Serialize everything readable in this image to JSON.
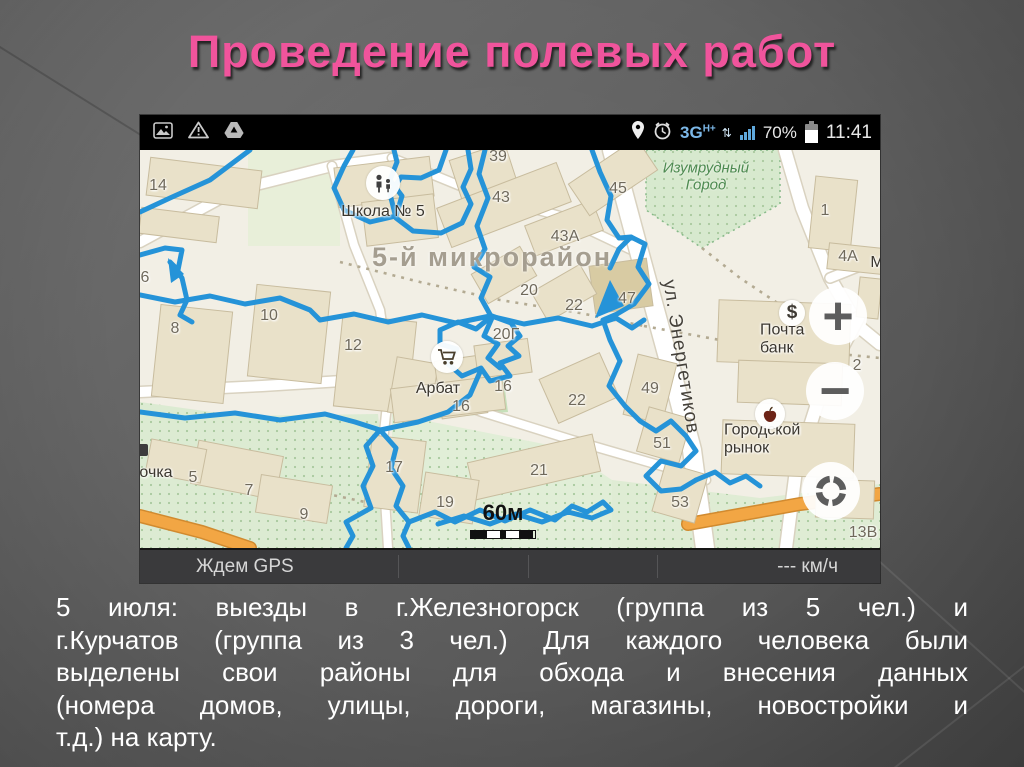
{
  "slide": {
    "title": "Проведение полевых работ",
    "title_color": "#f0549c",
    "body_lines": [
      "5 июля: выезды в г.Железногорск (группа из 5 чел.) и",
      "г.Курчатов (группа из 3 чел.) Для каждого человека были",
      "выделены свои районы для обхода и внесения данных",
      "(номера домов, улицы, дороги, магазины, новостройки и",
      "т.д.) на карту."
    ]
  },
  "phone": {
    "status_bar": {
      "left_icons": [
        "gallery-icon",
        "warning-icon",
        "drive-icon"
      ],
      "right_icons": [
        "location-pin-icon",
        "alarm-clock-icon",
        "signal-bars-icon",
        "battery-icon"
      ],
      "network": "3G",
      "network_super": "H+",
      "battery_percent": "70%",
      "time": "11:41"
    },
    "bottom_bar": {
      "gps_status": "Ждем GPS",
      "speed": "--- км/ч"
    },
    "map": {
      "scale_label": "60м",
      "controls": {
        "zoom_in": "+",
        "zoom_out": "−"
      },
      "poi_dollar_glyph": "$",
      "palette": {
        "map_bg": "#f2efe5",
        "building": "#e9e1c9",
        "building_dark": "#d8cba3",
        "building_edge": "#c8bc9e",
        "green_border": "#86b988",
        "tree_dot": "#a9c99e",
        "path_dot": "#b3aa92",
        "road_white": "#ffffff",
        "road_casing": "#d9d2c0",
        "road_orange": "#f2a644"
      },
      "track": {
        "color": "#2593d8",
        "width": 5,
        "lines": [
          "213,0 204,16 194,38 204,60 230,72 256,66 262,46 250,30 257,12 254,0",
          "306,0 299,20 281,28 261,27 250,44 256,68 273,81 301,83 322,73 331,54 323,37 331,19 328,0",
          "345,0 339,24 348,48 337,76 345,99 334,117 350,127 341,148 352,168 344,186 358,194 348,208 360,218",
          "180,170 214,164 248,172 282,165 316,173 350,166 384,174 418,168 452,176 476,168 492,178 504,170",
          "300,180 318,172 336,179 352,166 371,173 380,186 368,196 379,206 360,213 370,226 350,231 341,218 322,226 307,213 317,199 300,194 300,180",
          "470,118 479,99 491,87 505,94 498,117 509,134 494,154 477,164 463,170 470,190 480,211 469,236 485,256 500,271 516,281 531,271 546,286 556,301 541,316 521,311 506,326 521,341 541,339 556,330",
          "452,0 460,22 471,46 467,70 479,88 491,87",
          "110,0 70,30 30,48 0,62",
          "0,105 25,98 42,100 38,120 30,112 42,128 47,150 40,165 52,172",
          "240,280 226,296 233,316 223,336 231,358 206,372 213,386 206,398",
          "240,280 256,298 251,318 263,336 256,356 269,372 263,386 269,398",
          "269,372 295,362 315,372 340,360 365,371 390,360 415,370 432,356 447,362 463,352 471,360 452,368 428,362 402,372 376,364 350,374 324,366 298,374",
          "556,330 575,322 590,333 606,326 620,336",
          "0,145 35,152 70,146 105,154 140,148 170,160 180,170",
          "0,262 45,268 95,263 140,270 185,264 215,272 240,280",
          "340,222 330,245 308,262 278,272 240,280"
        ],
        "arrows": [
          "455,168 470,130 484,156",
          "28,108 44,124 31,133"
        ]
      },
      "greens": [
        {
          "pts": "108,0 200,0 200,96 108,96",
          "fill": "#e8efd9",
          "dots": false,
          "border": false
        },
        {
          "pts": "506,0 640,0 640,54 562,98 506,60",
          "fill": "#d7e9ce",
          "dots": true,
          "border": true
        },
        {
          "pts": "0,252 100,266 238,264 252,398 0,398",
          "fill": "#dcebd2",
          "dots": true,
          "border": false
        },
        {
          "pts": "252,264 424,298 472,330 472,398 252,398",
          "fill": "#e1eed7",
          "dots": true,
          "border": false
        },
        {
          "pts": "472,330 620,348 740,334 740,398 472,398",
          "fill": "#dfecd4",
          "dots": true,
          "border": false
        },
        {
          "pts": "258,240 364,232 368,262 262,272",
          "fill": "#c6e0ba",
          "dots": false,
          "border": false
        }
      ],
      "roads": [
        {
          "pts": "0,92 96,40 192,16 252,8",
          "w": 10,
          "color": "#ffffff",
          "casing": "#d9d2c0"
        },
        {
          "pts": "252,8 340,44 420,66 500,104",
          "w": 8,
          "color": "#ffffff",
          "casing": "#d9d2c0"
        },
        {
          "pts": "192,16 214,95 240,160 250,228",
          "w": 8,
          "color": "#ffffff",
          "casing": "#d9d2c0"
        },
        {
          "pts": "0,242 122,236 250,228",
          "w": 10,
          "color": "#ffffff",
          "casing": "#d9d2c0"
        },
        {
          "pts": "250,228 242,300 248,398",
          "w": 8,
          "color": "#ffffff",
          "casing": "#d9d2c0"
        },
        {
          "pts": "250,228 342,262 432,290 522,316 566,330",
          "w": 8,
          "color": "#ffffff",
          "casing": "#d9d2c0"
        },
        {
          "pts": "472,0 500,105 530,215 552,300 565,398",
          "w": 18,
          "color": "#ffffff",
          "casing": "#d9d2c0"
        },
        {
          "pts": "645,0 662,58 690,128 718,176 740,194",
          "w": 12,
          "color": "#ffffff",
          "casing": "#d9d2c0"
        },
        {
          "pts": "718,168 684,232 656,320 646,398",
          "w": 12,
          "color": "#ffffff",
          "casing": "#d9d2c0"
        },
        {
          "pts": "690,128 740,108",
          "w": 9,
          "color": "#ffffff",
          "casing": "#d9d2c0"
        },
        {
          "pts": "548,374 660,354 740,344",
          "w": 11,
          "color": "#f2a644",
          "casing": "#d18a2f"
        },
        {
          "pts": "0,366 62,382 110,398",
          "w": 11,
          "color": "#f2a644",
          "casing": "#d18a2f"
        }
      ],
      "paths_dotted": [
        "200,112 280,132 360,150 440,163 504,176",
        "504,176 580,190 660,200 740,208",
        "20,300 90,318 160,338 225,352",
        "562,98 600,128 645,158"
      ],
      "buildings": [
        [
          8,
          14,
          112,
          38,
          7
        ],
        [
          0,
          62,
          78,
          26,
          7
        ],
        [
          196,
          12,
          96,
          40,
          -7
        ],
        [
          224,
          48,
          72,
          44,
          -7
        ],
        [
          318,
          0,
          58,
          66,
          -18
        ],
        [
          300,
          34,
          128,
          42,
          -21
        ],
        [
          388,
          62,
          72,
          32,
          -21
        ],
        [
          432,
          8,
          82,
          38,
          -34
        ],
        [
          452,
          112,
          58,
          48,
          -8,
          1
        ],
        [
          672,
          28,
          42,
          72,
          6
        ],
        [
          688,
          96,
          62,
          26,
          6
        ],
        [
          718,
          128,
          22,
          40,
          6
        ],
        [
          578,
          152,
          132,
          62,
          2
        ],
        [
          598,
          212,
          104,
          42,
          2
        ],
        [
          582,
          272,
          132,
          54,
          2
        ],
        [
          16,
          158,
          72,
          92,
          6
        ],
        [
          112,
          138,
          74,
          92,
          6
        ],
        [
          198,
          168,
          74,
          92,
          6
        ],
        [
          336,
          108,
          56,
          34,
          -30
        ],
        [
          396,
          126,
          56,
          34,
          -30
        ],
        [
          252,
          210,
          42,
          56,
          10
        ],
        [
          298,
          208,
          46,
          58,
          -8
        ],
        [
          336,
          192,
          54,
          34,
          -8
        ],
        [
          406,
          214,
          66,
          48,
          -24
        ],
        [
          490,
          208,
          40,
          62,
          14
        ],
        [
          502,
          262,
          44,
          46,
          16
        ],
        [
          518,
          318,
          44,
          50,
          16
        ],
        [
          330,
          298,
          128,
          38,
          -13
        ],
        [
          228,
          288,
          54,
          72,
          7
        ],
        [
          282,
          326,
          54,
          44,
          9
        ],
        [
          54,
          298,
          86,
          44,
          11
        ],
        [
          118,
          330,
          72,
          38,
          9
        ],
        [
          8,
          294,
          56,
          34,
          11
        ],
        [
          252,
          232,
          112,
          34,
          -7
        ],
        [
          676,
          330,
          58,
          38,
          2
        ]
      ],
      "labels": [
        {
          "t": "14",
          "x": 18,
          "y": 36,
          "cls": "num"
        },
        {
          "t": "6",
          "x": 5,
          "y": 128,
          "cls": "num"
        },
        {
          "t": "39",
          "x": 358,
          "y": 7,
          "cls": "num"
        },
        {
          "t": "43",
          "x": 361,
          "y": 48,
          "cls": "num"
        },
        {
          "t": "43А",
          "x": 425,
          "y": 87,
          "cls": "num"
        },
        {
          "t": "45",
          "x": 478,
          "y": 39,
          "cls": "num"
        },
        {
          "t": "1",
          "x": 685,
          "y": 61,
          "cls": "num"
        },
        {
          "t": "4А",
          "x": 708,
          "y": 107,
          "cls": "num"
        },
        {
          "t": "М",
          "x": 737,
          "y": 113,
          "cls": "poi"
        },
        {
          "t": "20",
          "x": 389,
          "y": 141,
          "cls": "num"
        },
        {
          "t": "22",
          "x": 434,
          "y": 156,
          "cls": "num"
        },
        {
          "t": "47",
          "x": 487,
          "y": 149,
          "cls": "num"
        },
        {
          "t": "2",
          "x": 717,
          "y": 216,
          "cls": "num"
        },
        {
          "t": "10",
          "x": 129,
          "y": 166,
          "cls": "num"
        },
        {
          "t": "8",
          "x": 35,
          "y": 179,
          "cls": "num"
        },
        {
          "t": "12",
          "x": 213,
          "y": 196,
          "cls": "num"
        },
        {
          "t": "20Г",
          "x": 366,
          "y": 185,
          "cls": "num"
        },
        {
          "t": "16",
          "x": 363,
          "y": 237,
          "cls": "num"
        },
        {
          "t": "16",
          "x": 321,
          "y": 257,
          "cls": "num"
        },
        {
          "t": "22",
          "x": 437,
          "y": 251,
          "cls": "num"
        },
        {
          "t": "49",
          "x": 510,
          "y": 239,
          "cls": "num"
        },
        {
          "t": "51",
          "x": 522,
          "y": 294,
          "cls": "num"
        },
        {
          "t": "53",
          "x": 540,
          "y": 353,
          "cls": "num"
        },
        {
          "t": "21",
          "x": 399,
          "y": 321,
          "cls": "num"
        },
        {
          "t": "17",
          "x": 254,
          "y": 318,
          "cls": "num"
        },
        {
          "t": "19",
          "x": 305,
          "y": 353,
          "cls": "num"
        },
        {
          "t": "7",
          "x": 109,
          "y": 341,
          "cls": "num"
        },
        {
          "t": "9",
          "x": 164,
          "y": 365,
          "cls": "num"
        },
        {
          "t": "5",
          "x": 53,
          "y": 328,
          "cls": "num"
        },
        {
          "t": "13В",
          "x": 723,
          "y": 383,
          "cls": "num"
        },
        {
          "t": "Школа № 5",
          "x": 243,
          "y": 62,
          "cls": "poi"
        },
        {
          "t": "Почта банк",
          "x": 660,
          "y": 189,
          "cls": "poi"
        },
        {
          "t": "Городской рынок",
          "x": 636,
          "y": 289,
          "cls": "poi"
        },
        {
          "t": "Арбат",
          "x": 298,
          "y": 239,
          "cls": "poi"
        },
        {
          "t": "очка",
          "x": 16,
          "y": 323,
          "cls": "poi"
        },
        {
          "t": "Изумрудный\nГород",
          "x": 566,
          "y": 27,
          "cls": "green"
        },
        {
          "t": "5-й микрорайон",
          "x": 352,
          "y": 108,
          "cls": "district"
        },
        {
          "t": "ул. Энергетиков",
          "x": 540,
          "y": 207,
          "cls": "street",
          "rot": 81
        }
      ]
    }
  }
}
